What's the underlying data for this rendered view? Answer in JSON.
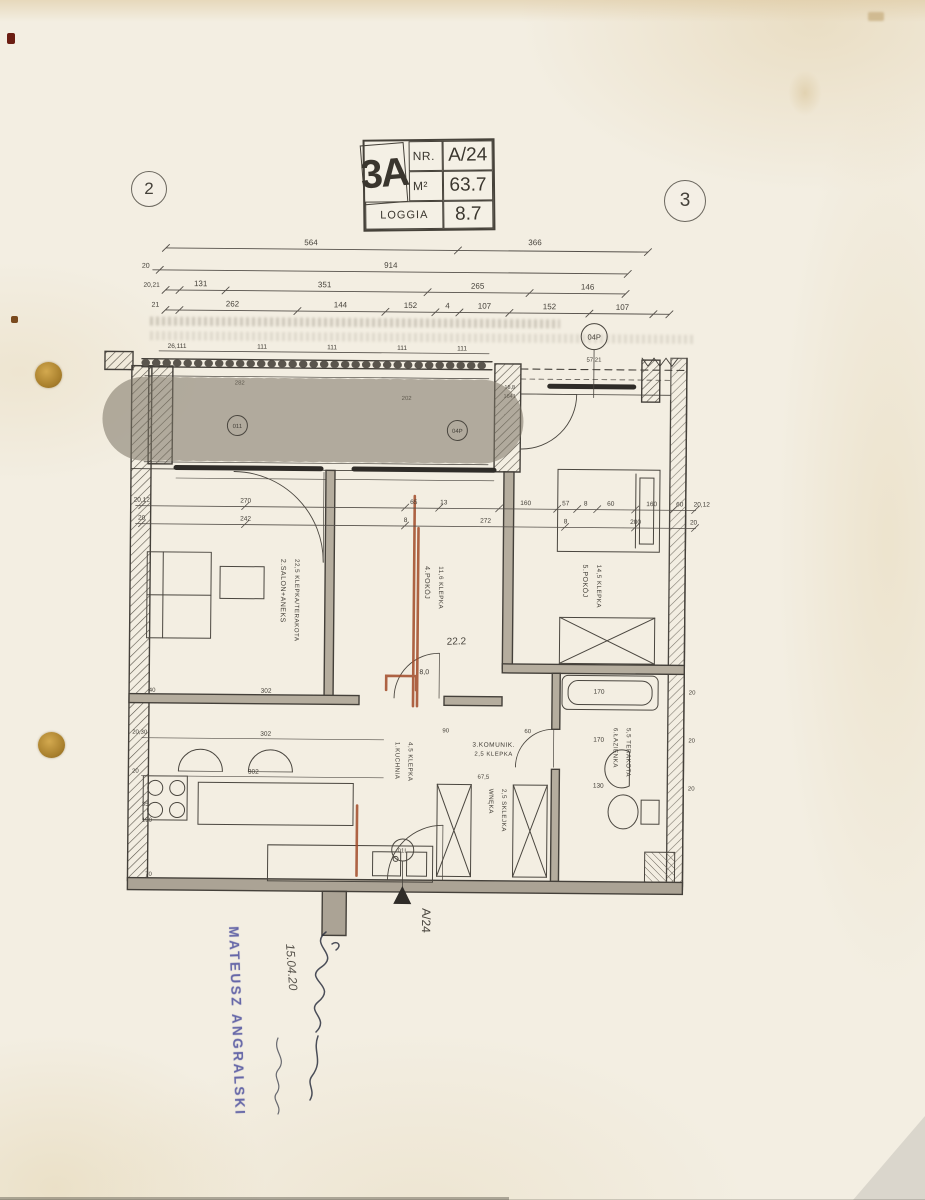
{
  "title_block": {
    "unit": "3A",
    "nr_label": "NR.",
    "nr_value": "A/24",
    "area_label": "M²",
    "area_value": "63.7",
    "loggia_label": "LOGGIA",
    "loggia_value": "8.7"
  },
  "grid_bubbles": {
    "left": "2",
    "right": "3"
  },
  "top_dims": {
    "row1": [
      "564",
      "366"
    ],
    "row2_left": "20",
    "row2": [
      "914"
    ],
    "row3_left": "20,21",
    "row3": [
      "131",
      "351",
      "265",
      "146"
    ],
    "row4_left": "21",
    "row4": [
      "262",
      "144",
      "152",
      "4",
      "107",
      "152",
      "107"
    ]
  },
  "loggia_dims": {
    "first": "26,111",
    "rep": [
      "111",
      "111",
      "111",
      "111"
    ],
    "right": "57,21",
    "small": [
      "282",
      "202",
      "18,8",
      "1641"
    ]
  },
  "interior_dims": {
    "rowA": [
      "20,12",
      "270",
      "65",
      "13",
      "160",
      "57",
      "8",
      "60",
      "160",
      "60",
      "20,12"
    ],
    "rowB": [
      "20",
      "242",
      "8",
      "272",
      "8",
      "200",
      "20"
    ],
    "kitchen": [
      "302",
      "302",
      "302"
    ],
    "left_col": [
      "40",
      "20,30",
      "20",
      "35",
      "190",
      "70"
    ],
    "bath": [
      "170",
      "170",
      "130"
    ],
    "bath_right": [
      "20",
      "20",
      "20"
    ],
    "hall": [
      "90",
      "67,5",
      "60"
    ],
    "pencil": "22.2",
    "handnote": "8,0"
  },
  "rooms": {
    "salon": {
      "line1": "2.SALON+ANEKS",
      "line2": "22,5 KLEPKA/TERAKOTA"
    },
    "pokoj4": {
      "line1": "4.POKÓJ",
      "line2": "11,6 KLEPKA"
    },
    "pokoj5": {
      "line1": "5.POKÓJ",
      "line2": "14,5 KLEPKA"
    },
    "komunik": {
      "line1": "3.KOMUNIK.",
      "line2": "2,5 KLEPKA"
    },
    "kuchnia": {
      "line1": "1.KUCHNIA",
      "line2": "4,5 KLEPKA"
    },
    "wneka": {
      "line1": "WNĘKA",
      "line2": "2,5 SKLEJKA"
    },
    "lazienka": {
      "line1": "6.ŁAZIENKA",
      "line2": "5,5 TERAKOTA"
    }
  },
  "markers": {
    "door_circle_1": "011",
    "door_circle_2": "04P",
    "top_right": "04P",
    "bottom": "01L",
    "entrance_unit": "A/24"
  },
  "annotations": {
    "stamp_name": "MATEUSZ ANGRALSKI",
    "handwritten_date": "15.04.20"
  },
  "colors": {
    "paper": "#f3eee2",
    "ink": "#45413a",
    "red_pencil": "#a14a28",
    "stamp_blue": "#4d4f9e",
    "hole": "#b9913f"
  }
}
